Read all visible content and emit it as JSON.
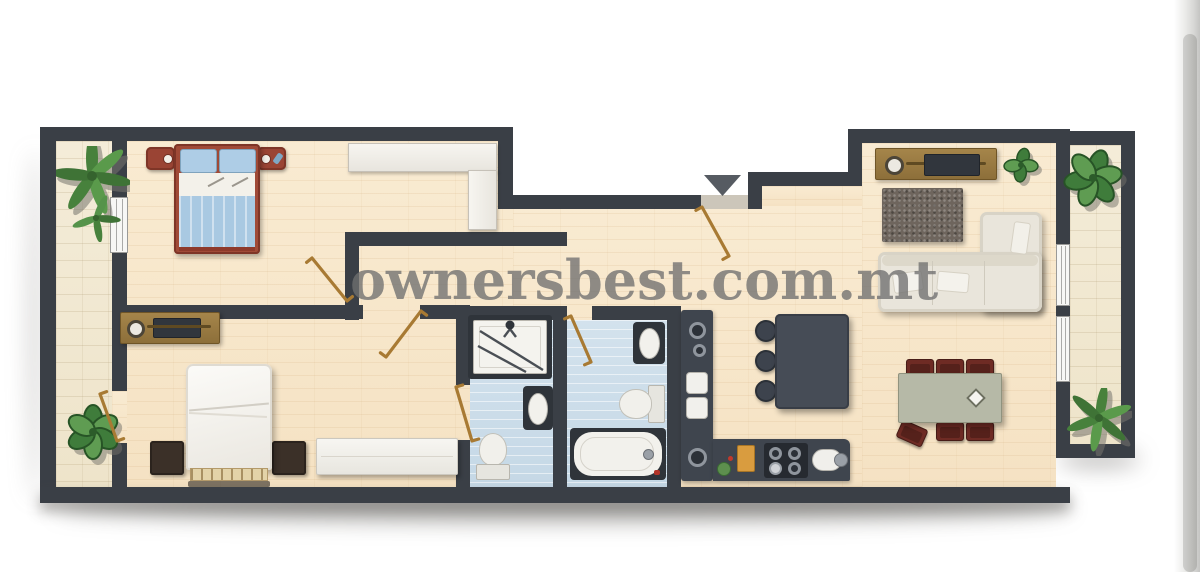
{
  "watermark": {
    "text": "ownersbest.com.mt",
    "color": "#707070"
  },
  "floor_plan": {
    "entrance_marker": "triangle-down",
    "rooms": [
      {
        "id": "balcony-left",
        "type": "balcony",
        "items": [
          "palm-plant",
          "leafy-plant"
        ]
      },
      {
        "id": "bedroom-1",
        "type": "bedroom",
        "items": [
          "double-bed",
          "nightstand-left",
          "nightstand-right",
          "built-in-wardrobe",
          "window",
          "door"
        ]
      },
      {
        "id": "bedroom-2",
        "type": "bedroom",
        "items": [
          "double-bed",
          "nightstand-left",
          "nightstand-right",
          "tv-sideboard",
          "dresser",
          "balcony-door",
          "ensuite-door"
        ]
      },
      {
        "id": "shower-room",
        "type": "bathroom",
        "items": [
          "shower",
          "washbasin",
          "toilet"
        ]
      },
      {
        "id": "bathroom",
        "type": "bathroom",
        "items": [
          "washbasin",
          "toilet",
          "bathtub",
          "door"
        ]
      },
      {
        "id": "kitchen",
        "type": "kitchen",
        "items": [
          "wall-counter",
          "double-sink",
          "hob",
          "sink",
          "cutting-board",
          "island",
          "stool",
          "stool",
          "stool"
        ]
      },
      {
        "id": "living-dining",
        "type": "living-room",
        "items": [
          "tv-sideboard",
          "plant",
          "rug",
          "corner-sofa",
          "sofa-pillows",
          "dining-table",
          "dining-chairs-x6",
          "balcony-windows"
        ]
      },
      {
        "id": "balcony-right",
        "type": "balcony",
        "items": [
          "leafy-plant",
          "palm-plant"
        ]
      }
    ]
  },
  "palette": {
    "wall": "#3a3f46",
    "floor_wood": "#f7e7cb",
    "floor_stone": "#f1e8d3",
    "floor_bath": "#cfdfe9",
    "bed_frame_red": "#9a4434",
    "bedding_blue": "#a9c9e2",
    "chair_red": "#6e2b24",
    "counter_dark": "#3f454e",
    "sofa_cream": "#e9e5db",
    "table_sage": "#b5b8a6",
    "wood_brown": "#94753f",
    "plant_green": "#4e8742",
    "door_swing_brown": "#a87a33"
  },
  "scrollbar": {
    "present": true
  }
}
